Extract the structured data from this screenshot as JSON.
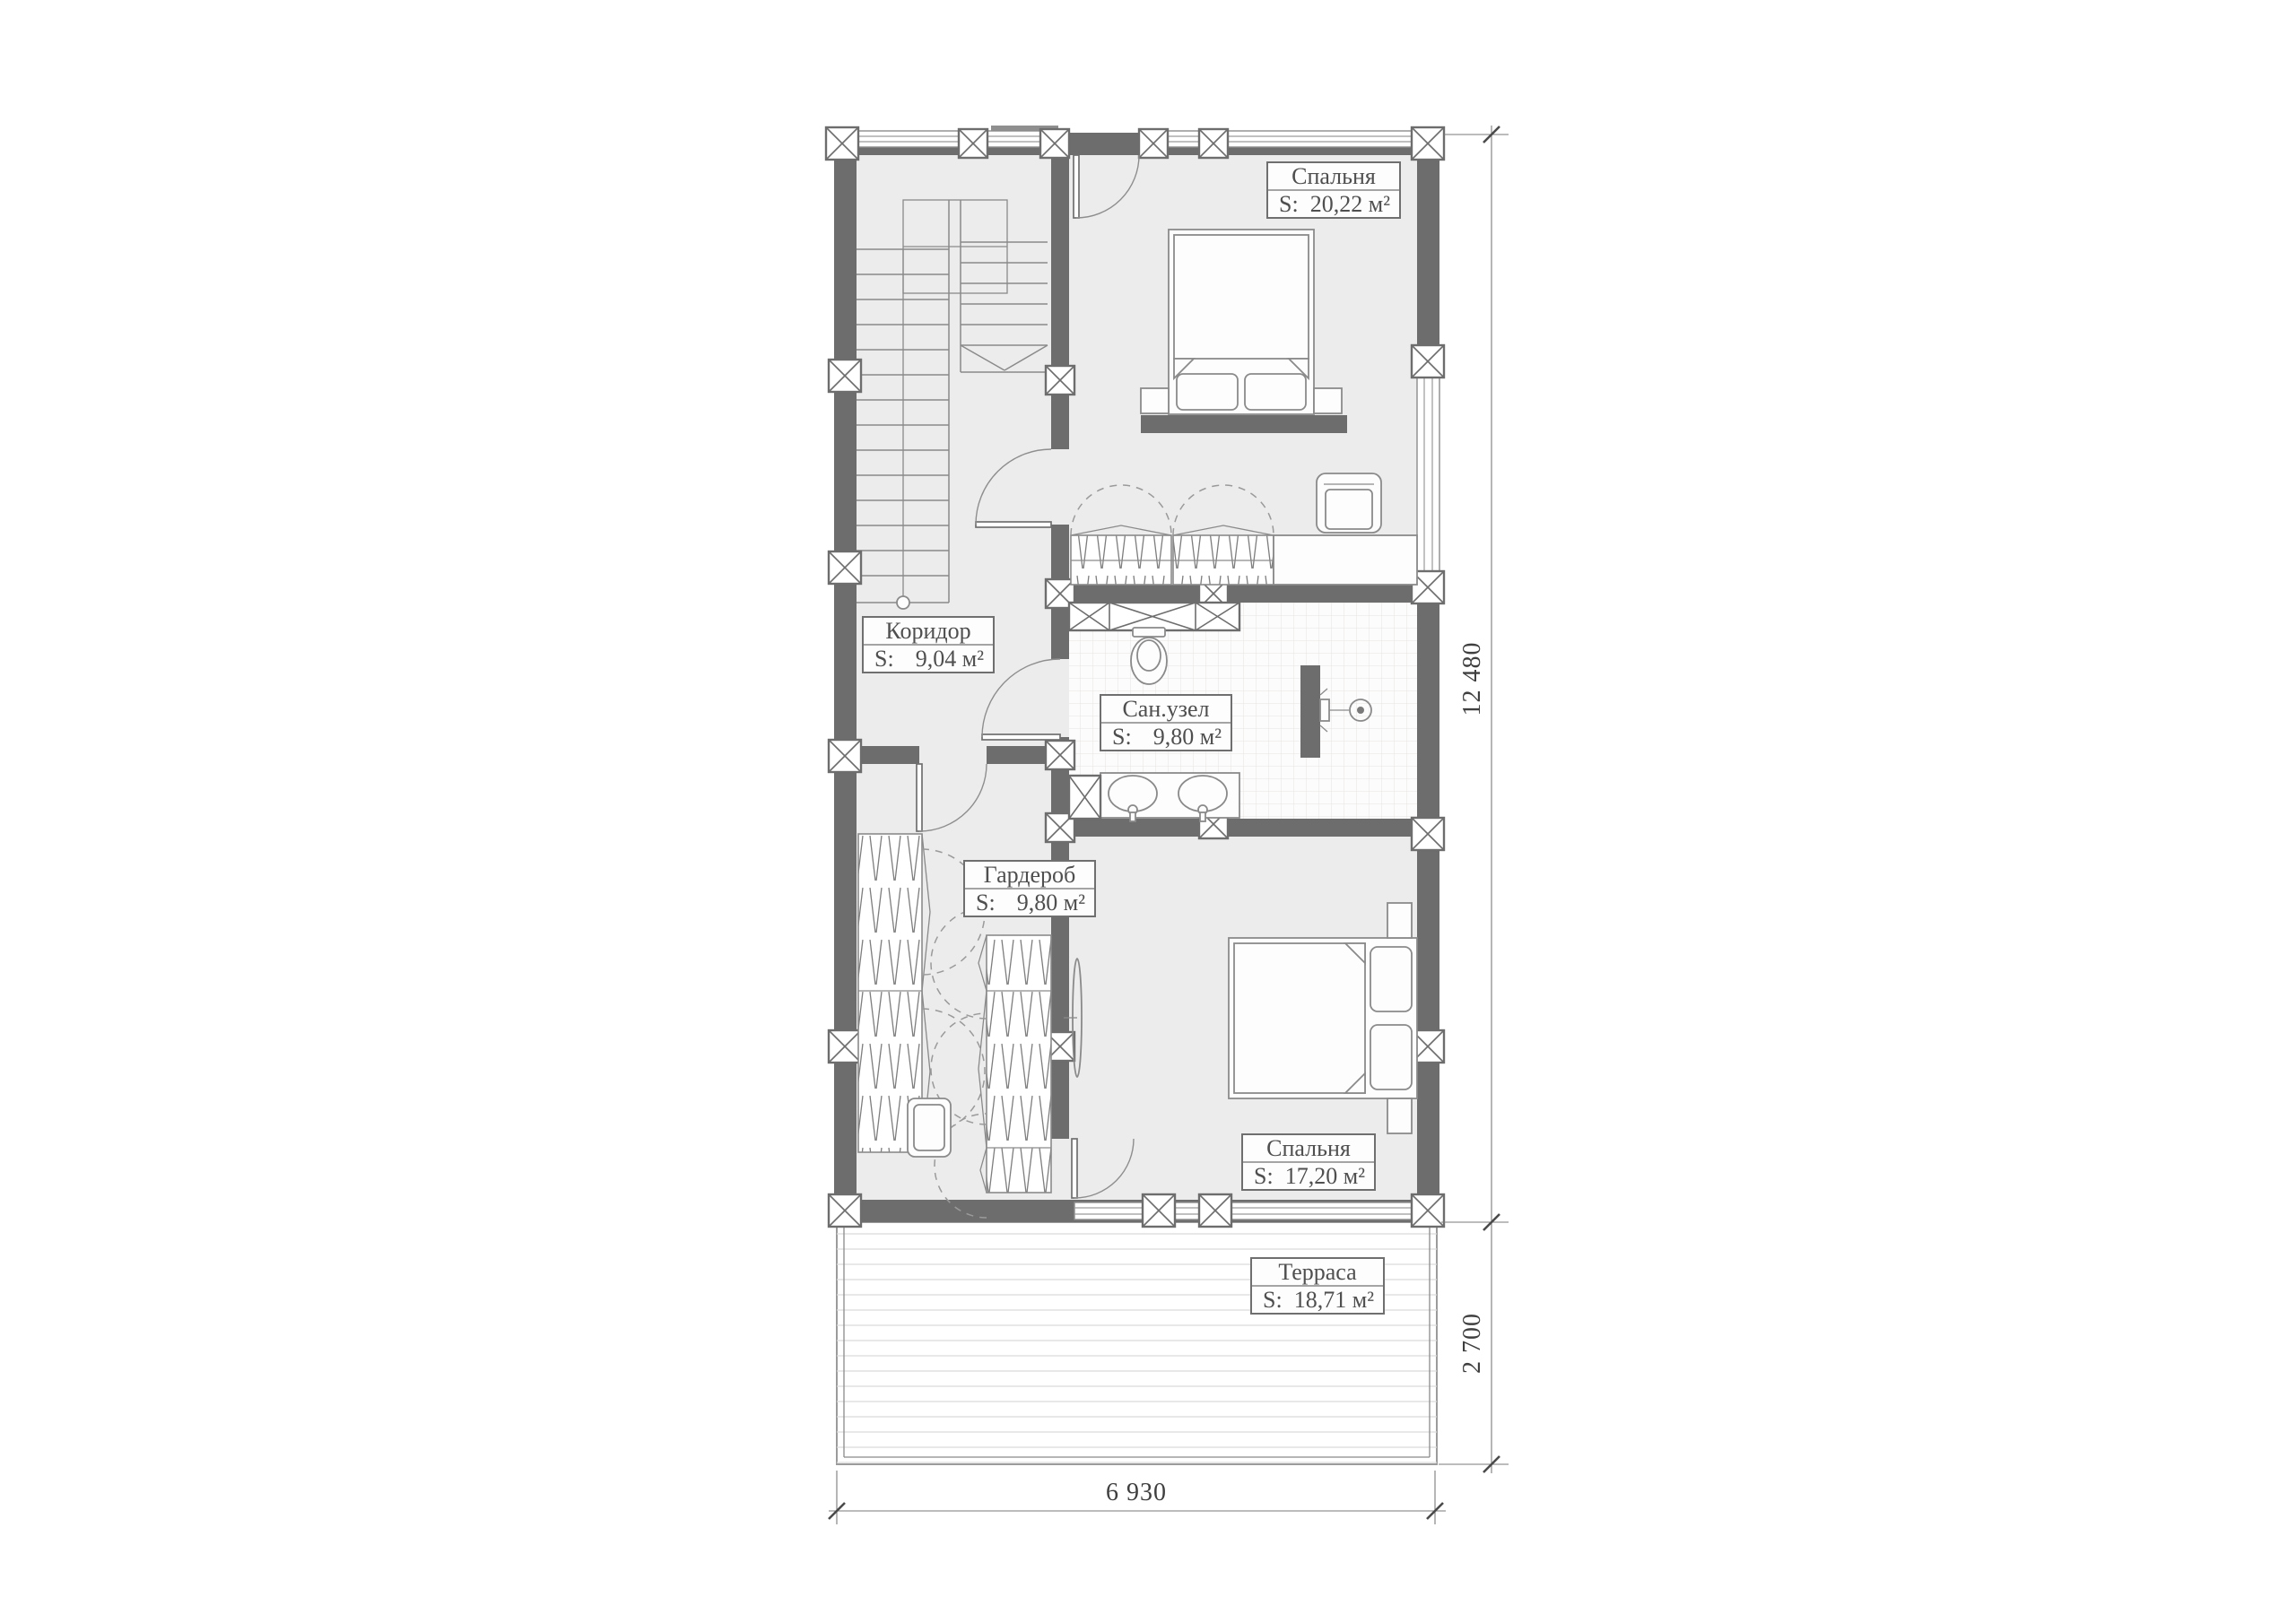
{
  "colors": {
    "wall": "#6d6d6d",
    "floor": "#ececec",
    "line": "#8a8a8a",
    "dash": "#9a9a9a",
    "text": "#4f4f4f",
    "dim_text": "#3f3f3f",
    "tile": "#e8e3e1",
    "deck": "#dbdbdb"
  },
  "rooms": [
    {
      "id": "bedroom-1",
      "name": "Спальня",
      "s_label": "S:",
      "area": "20,22 м²"
    },
    {
      "id": "corridor",
      "name": "Коридор",
      "s_label": "S:",
      "area": "9,04 м²"
    },
    {
      "id": "bathroom",
      "name": "Сан.узел",
      "s_label": "S:",
      "area": "9,80 м²"
    },
    {
      "id": "wardrobe",
      "name": "Гардероб",
      "s_label": "S:",
      "area": "9,80 м²"
    },
    {
      "id": "bedroom-2",
      "name": "Спальня",
      "s_label": "S:",
      "area": "17,20 м²"
    },
    {
      "id": "terrace",
      "name": "Терраса",
      "s_label": "S:",
      "area": "18,71 м²"
    }
  ],
  "dimensions": {
    "right_main": "12 480",
    "right_terrace": "2 700",
    "bottom_width": "6 930"
  }
}
